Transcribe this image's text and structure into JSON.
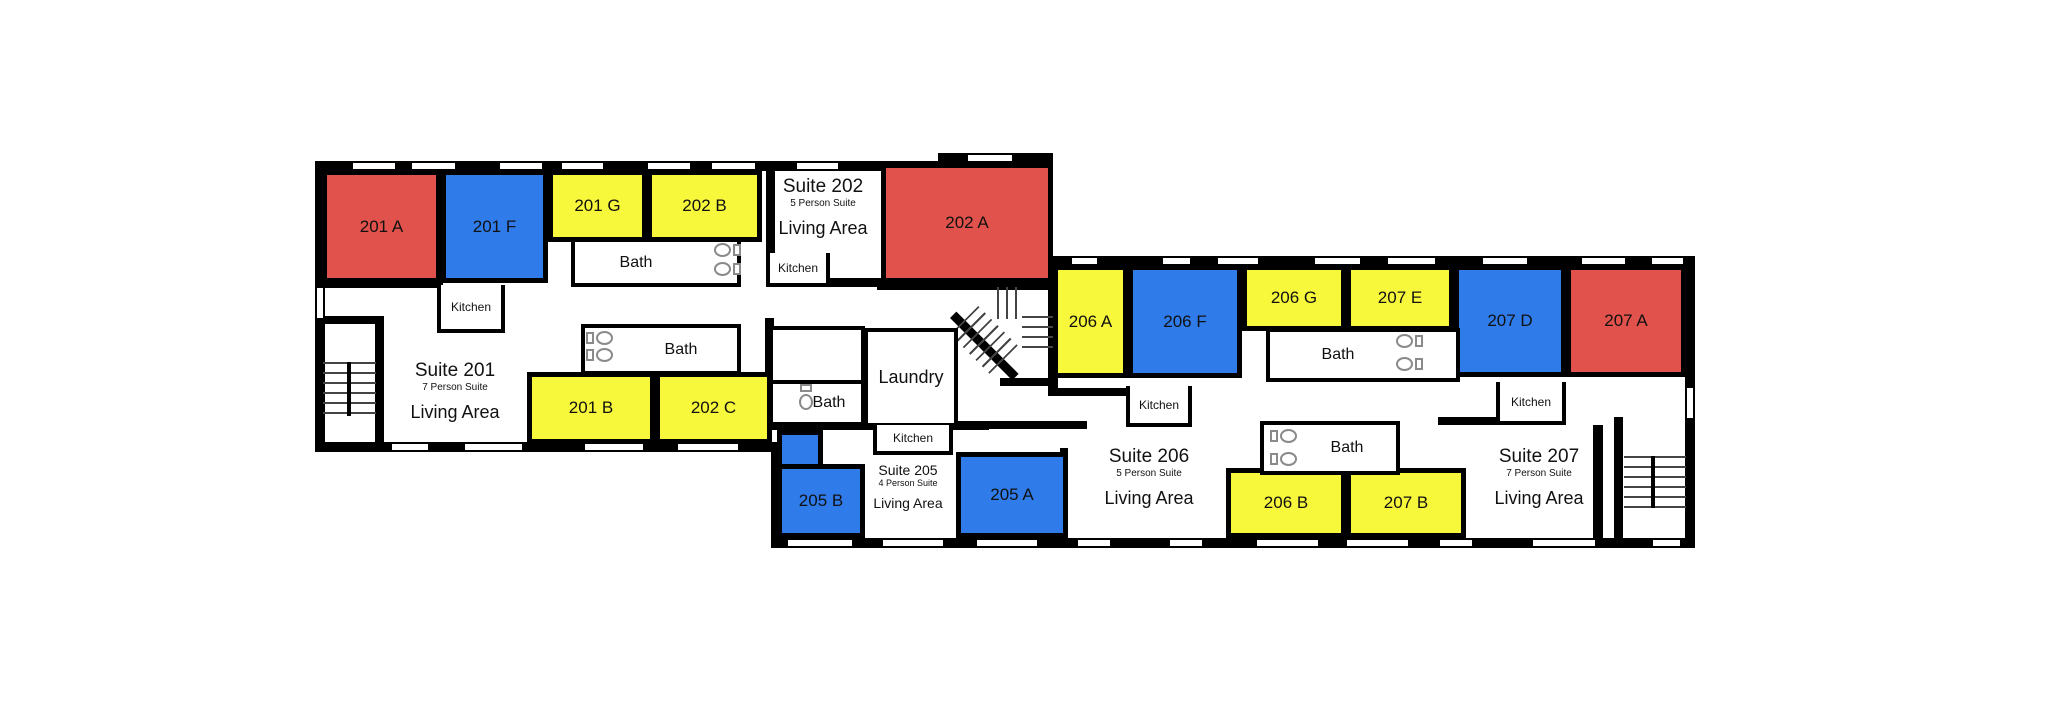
{
  "colors": {
    "red": "#e0524b",
    "blue": "#2e7be9",
    "yellow": "#f7f73c",
    "wall": "#000000",
    "floor": "#ffffff",
    "fixture": "#8a8a8a"
  },
  "rooms": {
    "r201a": {
      "label": "201 A",
      "color": "red"
    },
    "r201f": {
      "label": "201 F",
      "color": "blue"
    },
    "r201g": {
      "label": "201 G",
      "color": "yellow"
    },
    "r201b": {
      "label": "201 B",
      "color": "yellow"
    },
    "r202a": {
      "label": "202 A",
      "color": "red"
    },
    "r202b": {
      "label": "202 B",
      "color": "yellow"
    },
    "r202c": {
      "label": "202 C",
      "color": "yellow"
    },
    "r205a": {
      "label": "205 A",
      "color": "blue"
    },
    "r205b": {
      "label": "205 B",
      "color": "blue"
    },
    "r206a": {
      "label": "206 A",
      "color": "yellow"
    },
    "r206f": {
      "label": "206 F",
      "color": "blue"
    },
    "r206g": {
      "label": "206 G",
      "color": "yellow"
    },
    "r206b": {
      "label": "206 B",
      "color": "yellow"
    },
    "r207e": {
      "label": "207 E",
      "color": "yellow"
    },
    "r207d": {
      "label": "207 D",
      "color": "blue"
    },
    "r207a": {
      "label": "207 A",
      "color": "red"
    },
    "r207b": {
      "label": "207 B",
      "color": "yellow"
    }
  },
  "suites": {
    "s201": {
      "title": "Suite 201",
      "occupancy": "7 Person Suite",
      "area": "Living Area"
    },
    "s202": {
      "title": "Suite 202",
      "occupancy": "5 Person Suite",
      "area": "Living Area"
    },
    "s205": {
      "title": "Suite 205",
      "occupancy": "4 Person Suite",
      "area": "Living Area"
    },
    "s206": {
      "title": "Suite 206",
      "occupancy": "5 Person Suite",
      "area": "Living Area"
    },
    "s207": {
      "title": "Suite 207",
      "occupancy": "7 Person Suite",
      "area": "Living Area"
    }
  },
  "labels": {
    "bath": "Bath",
    "kitchen": "Kitchen",
    "laundry": "Laundry"
  }
}
